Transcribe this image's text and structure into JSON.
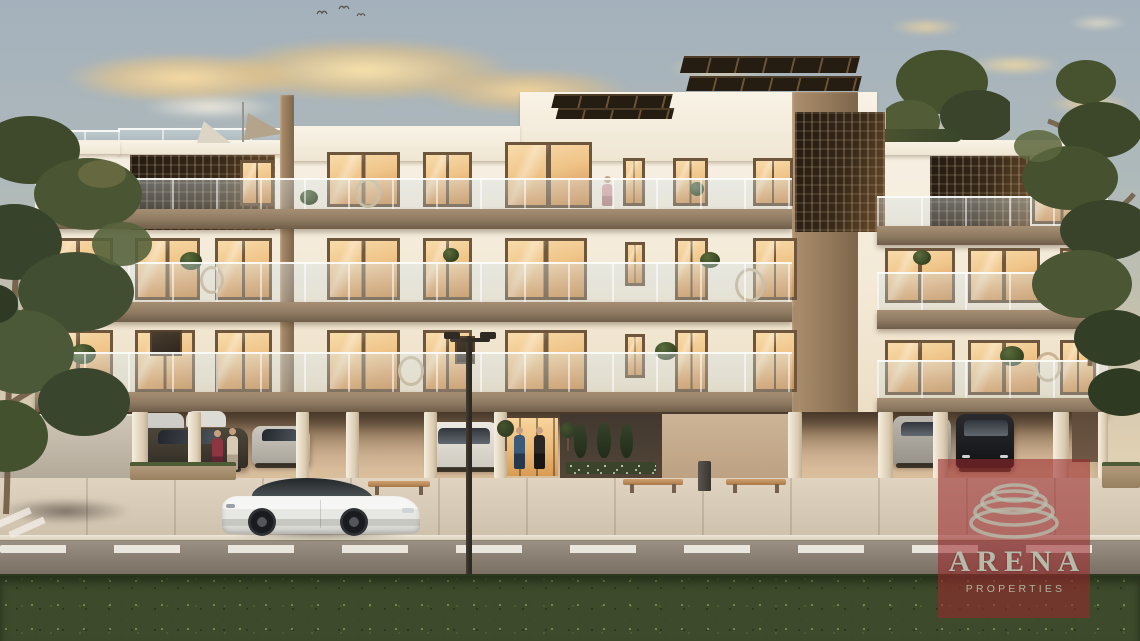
{
  "meta": {
    "kind": "architectural render photo",
    "scene": "Modern three-storey apartment building at dusk with covered ground-floor parking, pedestrians, a white sports car on the street and a green hedge in the foreground"
  },
  "watermark": {
    "brand": "ARENA",
    "subtitle": "PROPERTIES",
    "panel_color": "#99292C",
    "text_color": "#BBC6B3",
    "logo": "spiral-coil"
  },
  "palette": {
    "sky_top": "#A4B1BC",
    "sky_horizon": "#EAD9BC",
    "cloud_gold": "#EFC489",
    "building_wall": "#F4EDE0",
    "window_glow": "#EEC488",
    "balcony_slab": "#8F7B63",
    "privacy_screen": "#37281A",
    "concrete_fin": "#977C5E",
    "solar_panel": "#2A2014",
    "road": "#8B8076",
    "sidewalk": "#D8CCBA",
    "hedge": "#3D4A2B",
    "street_car": "#EFEFED"
  }
}
